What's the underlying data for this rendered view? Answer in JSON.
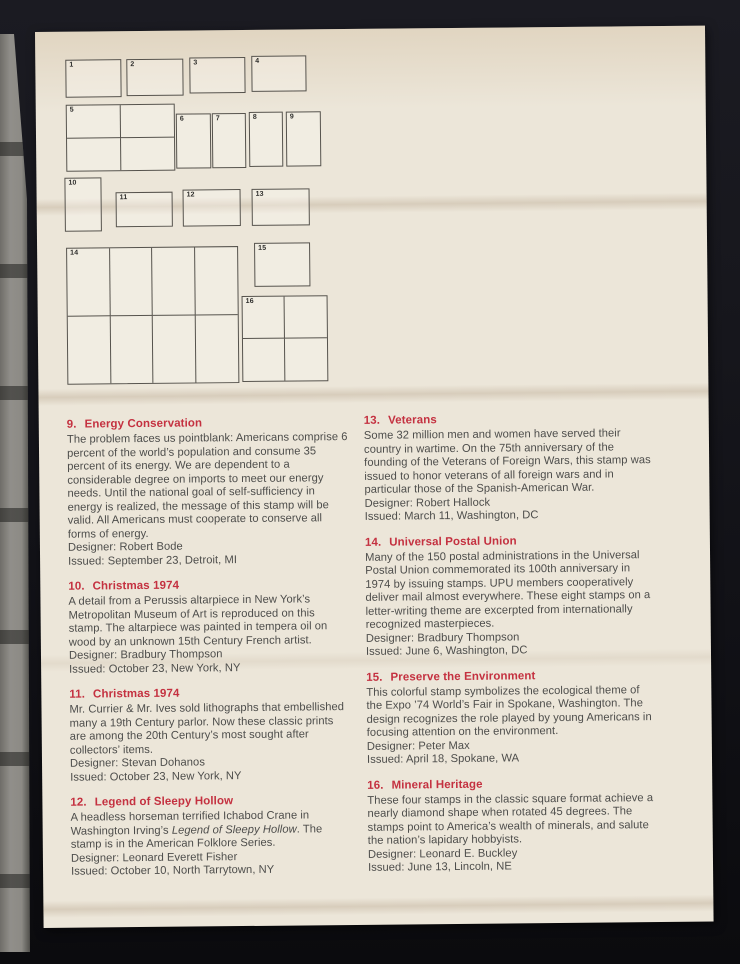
{
  "scene": {
    "background_color": "#14141a",
    "book_edge_color": "#8c8a85"
  },
  "page": {
    "paper_color": "#ece6d9",
    "heading_color": "#c43140",
    "body_color": "#4d4d4b",
    "diagram": {
      "boxes": [
        {
          "label": "1",
          "x": 30,
          "y": 28,
          "w": 54,
          "h": 36,
          "cols": 1,
          "rows": 1
        },
        {
          "label": "2",
          "x": 91,
          "y": 28,
          "w": 55,
          "h": 35,
          "cols": 1,
          "rows": 1
        },
        {
          "label": "3",
          "x": 154,
          "y": 27,
          "w": 54,
          "h": 34,
          "cols": 1,
          "rows": 1
        },
        {
          "label": "4",
          "x": 216,
          "y": 26,
          "w": 53,
          "h": 34,
          "cols": 1,
          "rows": 1
        },
        {
          "label": "5",
          "x": 30,
          "y": 73,
          "w": 107,
          "h": 65,
          "cols": 2,
          "rows": 2
        },
        {
          "label": "6",
          "x": 140,
          "y": 83,
          "w": 33,
          "h": 53,
          "cols": 1,
          "rows": 1
        },
        {
          "label": "7",
          "x": 176,
          "y": 83,
          "w": 32,
          "h": 53,
          "cols": 1,
          "rows": 1
        },
        {
          "label": "8",
          "x": 213,
          "y": 82,
          "w": 32,
          "h": 53,
          "cols": 1,
          "rows": 1
        },
        {
          "label": "9",
          "x": 250,
          "y": 82,
          "w": 33,
          "h": 53,
          "cols": 1,
          "rows": 1
        },
        {
          "label": "10",
          "x": 28,
          "y": 146,
          "w": 35,
          "h": 52,
          "cols": 1,
          "rows": 1
        },
        {
          "label": "11",
          "x": 79,
          "y": 161,
          "w": 55,
          "h": 33,
          "cols": 1,
          "rows": 1
        },
        {
          "label": "12",
          "x": 146,
          "y": 159,
          "w": 56,
          "h": 35,
          "cols": 1,
          "rows": 1
        },
        {
          "label": "13",
          "x": 215,
          "y": 159,
          "w": 56,
          "h": 35,
          "cols": 1,
          "rows": 1
        },
        {
          "label": "14",
          "x": 29,
          "y": 216,
          "w": 170,
          "h": 135,
          "cols": 4,
          "rows": 2
        },
        {
          "label": "15",
          "x": 217,
          "y": 213,
          "w": 54,
          "h": 42,
          "cols": 1,
          "rows": 1
        },
        {
          "label": "16",
          "x": 204,
          "y": 266,
          "w": 84,
          "h": 84,
          "cols": 2,
          "rows": 2
        }
      ]
    },
    "sections_left": [
      {
        "number": "9.",
        "title": "Energy Conservation",
        "body": [
          {
            "t": "The problem faces us pointblank: Americans comprise 6 percent of the world’s population and consume 35 percent of its energy. We are dependent to a considerable degree on imports to meet our energy needs. Until the national goal of self-sufficiency in energy is realized, the message of this stamp will be valid. All Americans must cooperate to conserve all forms of energy."
          }
        ],
        "designer": "Designer: Robert Bode",
        "issued": "Issued: September 23, Detroit, MI"
      },
      {
        "number": "10.",
        "title": "Christmas 1974",
        "body": [
          {
            "t": "A detail from a Perussis altarpiece in New York’s Metropolitan Museum of Art is reproduced on this stamp. The altarpiece was painted in tempera oil on wood by an unknown 15th Century French artist."
          }
        ],
        "designer": "Designer: Bradbury Thompson",
        "issued": "Issued: October 23, New York, NY"
      },
      {
        "number": "11.",
        "title": "Christmas 1974",
        "body": [
          {
            "t": "Mr. Currier & Mr. Ives sold lithographs that embellished many a 19th Century parlor. Now these classic prints are among the 20th Century’s most sought after collectors’ items."
          }
        ],
        "designer": "Designer: Stevan Dohanos",
        "issued": "Issued: October 23, New York, NY"
      },
      {
        "number": "12.",
        "title": "Legend of Sleepy Hollow",
        "body": [
          {
            "t": "A headless horseman terrified Ichabod Crane in Washington Irving’s "
          },
          {
            "t": "Legend of Sleepy Hollow",
            "i": true
          },
          {
            "t": ". The stamp is in the American Folklore Series."
          }
        ],
        "designer": "Designer: Leonard Everett Fisher",
        "issued": "Issued: October 10, North Tarrytown, NY"
      }
    ],
    "sections_right": [
      {
        "number": "13.",
        "title": "Veterans",
        "body": [
          {
            "t": "Some 32 million men and women have served their country in wartime. On the 75th anniversary of the founding of the Veterans of Foreign Wars, this stamp was issued to honor veterans of all foreign wars and in particular those of the Spanish-American War."
          }
        ],
        "designer": "Designer: Robert Hallock",
        "issued": "Issued: March 11, Washington, DC"
      },
      {
        "number": "14.",
        "title": "Universal Postal Union",
        "body": [
          {
            "t": "Many of the 150 postal administrations in the Universal Postal Union commemorated its 100th anniversary in 1974 by issuing stamps. UPU members cooperatively deliver mail almost everywhere. These eight stamps on a letter-writing theme are excerpted from internationally recognized masterpieces."
          }
        ],
        "designer": "Designer: Bradbury Thompson",
        "issued": "Issued: June 6, Washington, DC"
      },
      {
        "number": "15.",
        "title": "Preserve the Environment",
        "body": [
          {
            "t": "This colorful stamp symbolizes the ecological theme of the Expo ’74 World’s Fair in Spokane, Washington. The design recognizes the role played by young Americans in focusing attention on the environment."
          }
        ],
        "designer": "Designer: Peter Max",
        "issued": "Issued: April 18, Spokane, WA"
      },
      {
        "number": "16.",
        "title": "Mineral Heritage",
        "body": [
          {
            "t": "These four stamps in the classic square format achieve a nearly diamond shape when rotated 45 degrees. The stamps point to America’s wealth of minerals, and salute the nation’s lapidary hobbyists."
          }
        ],
        "designer": "Designer: Leonard E. Buckley",
        "issued": "Issued: June 13, Lincoln, NE"
      }
    ]
  }
}
